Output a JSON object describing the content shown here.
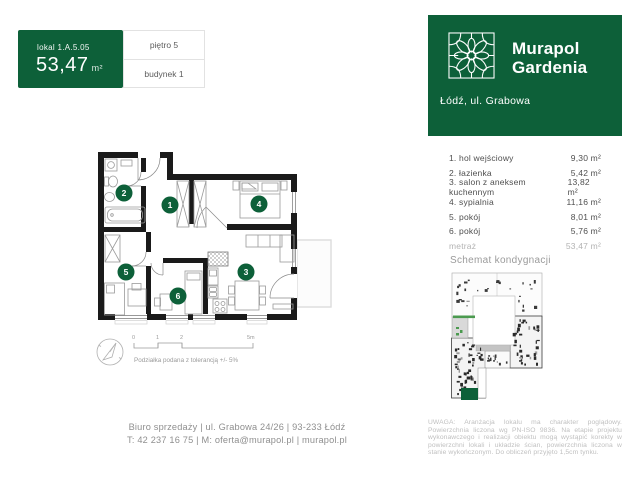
{
  "unit_card": {
    "lokal_label": "lokal 1.A.5.05",
    "area_value": "53,47",
    "area_unit": "m²",
    "floor": "piętro 5",
    "building": "budynek 1"
  },
  "brand": {
    "name_line1": "Murapol",
    "name_line2": "Gardenia",
    "location": "Łódź, ul. Grabowa",
    "green": "#0d6039",
    "logo_icon": "gardenia-flower-tile"
  },
  "rooms": {
    "items": [
      {
        "label": "1. hol wejściowy",
        "area": "9,30 m²"
      },
      {
        "label": "2. łazienka",
        "area": "5,42 m²"
      },
      {
        "label": "3. salon z aneksem kuchennym",
        "area": "13,82 m²"
      },
      {
        "label": "4. sypialnia",
        "area": "11,16 m²"
      },
      {
        "label": "5. pokój",
        "area": "8,01 m²"
      },
      {
        "label": "6. pokój",
        "area": "5,76 m²"
      }
    ],
    "total_label": "metraż",
    "total_area": "53,47 m²"
  },
  "schematic": {
    "title": "Schemat kondygnacji"
  },
  "plan": {
    "room_numbers": [
      "1",
      "2",
      "3",
      "4",
      "5",
      "6"
    ],
    "scale_ticks": {
      "t0": "0",
      "t1": "1",
      "t2": "2",
      "t5": "5m"
    },
    "tolerance_note": "Podziałka podana z tolerancją +/- 5%"
  },
  "footer": {
    "line1": "Biuro sprzedaży | ul. Grabowa 24/26  | 93-233 Łódź",
    "line2": "T: 42 237 16 75 | M: oferta@murapol.pl | murapol.pl"
  },
  "disclaimer": "UWAGA: Aranżacja lokalu ma charakter poglądowy. Powierzchnia liczona wg PN-ISO 9836. Na etapie projektu wykonawczego i realizacji obiektu mogą wystąpić korekty w powierzchni lokali i układzie ścian, powierzchnia liczona w stanie wykończonym. Do obliczeń przyjęto 1,5cm tynku."
}
